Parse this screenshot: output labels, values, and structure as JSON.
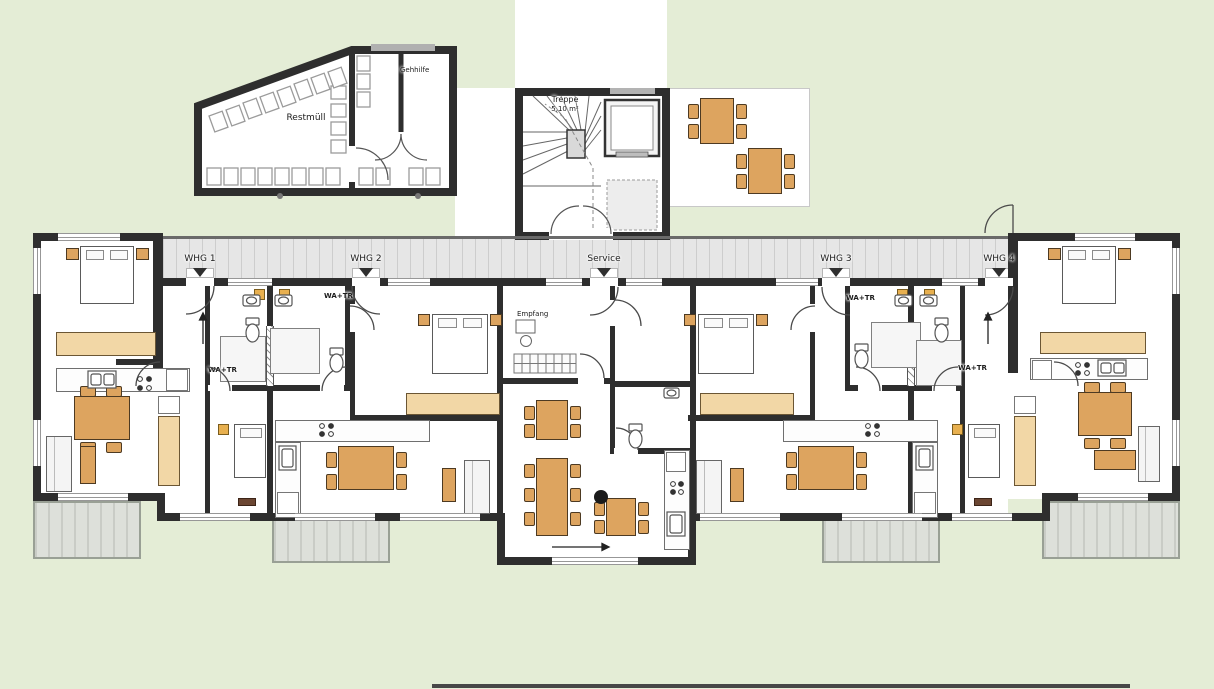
{
  "labels": {
    "waste_room": "Restmüll",
    "walking_aid_room": "Gehhilfe",
    "stairs": "Treppe",
    "stairs_area": "5,10 m²",
    "reception": "Empfang",
    "washer_dryer": "WA+TR"
  },
  "units": [
    {
      "label": "WHG 1"
    },
    {
      "label": "WHG 2"
    },
    {
      "label": "Service"
    },
    {
      "label": "WHG 3"
    },
    {
      "label": "WHG 4"
    }
  ],
  "colors": {
    "background": "#e4edd6",
    "wall": "#2e2e2e",
    "wood": "#dda45f",
    "wardrobe": "#f2d7a6",
    "corridor": "#e6e6e6",
    "balcony": "#dde0da"
  }
}
